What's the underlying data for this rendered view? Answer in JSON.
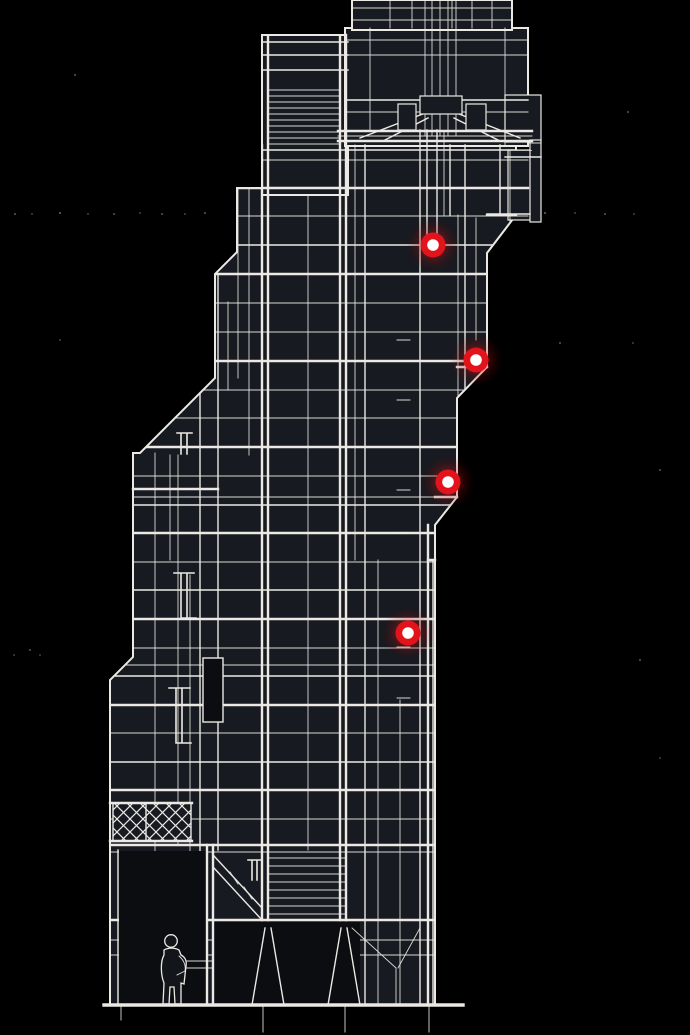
{
  "canvas": {
    "width": 690,
    "height": 1035
  },
  "palette": {
    "background": "#000000",
    "ink": "#ece9e4",
    "panel": "#171a20",
    "panel_dark": "#0b0d10",
    "marker_red": "#e3131b",
    "marker_core": "#ffffff",
    "marker_glow": "#ff1a1a"
  },
  "markers": {
    "outer_radius": 12.5,
    "core_radius": 5.8,
    "glow_radius": 27,
    "items": [
      {
        "id": "hotspot-1",
        "x": 433,
        "y": 245
      },
      {
        "id": "hotspot-2",
        "x": 476,
        "y": 360
      },
      {
        "id": "hotspot-3",
        "x": 448,
        "y": 482
      },
      {
        "id": "hotspot-4",
        "x": 408,
        "y": 633
      }
    ]
  },
  "figure": {
    "x": 171,
    "y_feet": 1005,
    "height": 70
  },
  "ground_y": 1005
}
